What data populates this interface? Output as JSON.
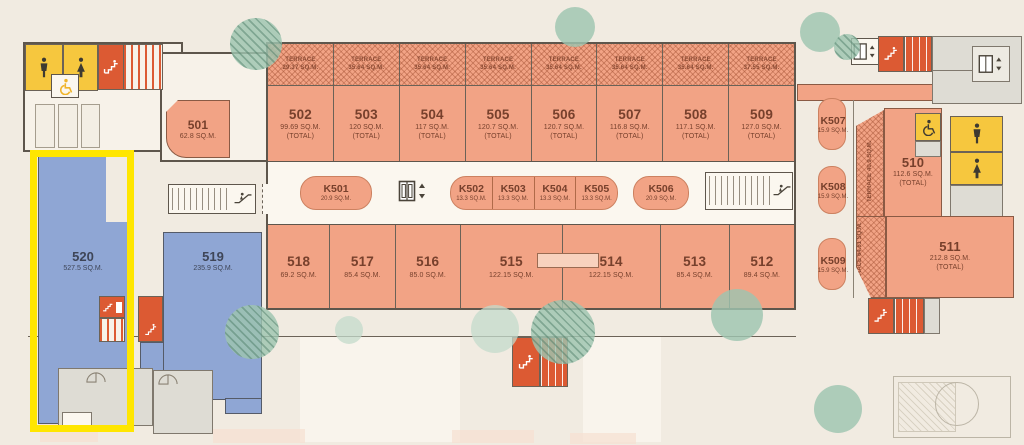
{
  "labels": {
    "terrace": "TERRACE",
    "total": "(TOTAL)"
  },
  "units": {
    "top": [
      {
        "id": "502",
        "area": "99.69 SQ.M.",
        "terrace_area": "29.37 SQ.M."
      },
      {
        "id": "503",
        "area": "120 SQ.M.",
        "terrace_area": "35.64 SQ.M."
      },
      {
        "id": "504",
        "area": "117 SQ.M.",
        "terrace_area": "35.64 SQ.M."
      },
      {
        "id": "505",
        "area": "120.7 SQ.M.",
        "terrace_area": "35.64 SQ.M."
      },
      {
        "id": "506",
        "area": "120.7 SQ.M.",
        "terrace_area": "35.64 SQ.M."
      },
      {
        "id": "507",
        "area": "116.8 SQ.M.",
        "terrace_area": "35.64 SQ.M."
      },
      {
        "id": "508",
        "area": "117.1 SQ.M.",
        "terrace_area": "35.64 SQ.M."
      },
      {
        "id": "509",
        "area": "127.0 SQ.M.",
        "terrace_area": "37.55 SQ.M."
      }
    ],
    "bottom": [
      {
        "id": "518",
        "area": "69.2 SQ.M."
      },
      {
        "id": "517",
        "area": "85.4 SQ.M."
      },
      {
        "id": "516",
        "area": "85.0 SQ.M."
      },
      {
        "id": "515",
        "area": "122.15 SQ.M."
      },
      {
        "id": "514",
        "area": "122.15 SQ.M."
      },
      {
        "id": "513",
        "area": "85.4 SQ.M."
      },
      {
        "id": "512",
        "area": "89.4 SQ.M."
      }
    ],
    "left": [
      {
        "id": "501",
        "area": "62.8 SQ.M."
      },
      {
        "id": "520",
        "area": "527.5 SQ.M.",
        "highlighted": true
      },
      {
        "id": "519",
        "area": "235.9 SQ.M."
      }
    ],
    "right": [
      {
        "id": "510",
        "area": "112.6 SQ.M.",
        "terrace_label": "TERRACE",
        "terrace_area": "40.9 SQ.M."
      },
      {
        "id": "511",
        "area": "212.8 SQ.M.",
        "terrace_label": "TERRACE",
        "terrace_area": "64.61 SQ.M."
      }
    ]
  },
  "kiosks": [
    {
      "id": "K501",
      "area": "20.9 SQ.M."
    },
    {
      "id": "K502",
      "area": "13.3 SQ.M."
    },
    {
      "id": "K503",
      "area": "13.3 SQ.M."
    },
    {
      "id": "K504",
      "area": "13.3 SQ.M."
    },
    {
      "id": "K505",
      "area": "13.3 SQ.M."
    },
    {
      "id": "K506",
      "area": "20.9 SQ.M."
    },
    {
      "id": "K507",
      "area": "15.9 SQ.M."
    },
    {
      "id": "K508",
      "area": "15.9 SQ.M."
    },
    {
      "id": "K509",
      "area": "15.9 SQ.M."
    }
  ],
  "colors": {
    "background": "#F1EBE1",
    "unit_fill": "#F2A385",
    "blue_fill": "#8FA6D4",
    "wc_yellow": "#F6C73E",
    "stair_red": "#DC5A33",
    "highlight_yellow": "#FFE600",
    "tree_green": "#9EC4B0",
    "unit_text": "#77402C",
    "blue_text": "#3E4557"
  },
  "icons": {
    "male": "male-restroom-icon",
    "female": "female-restroom-icon",
    "wheelchair": "wheelchair-icon",
    "stairs": "stairs-icon",
    "escalator": "escalator-icon",
    "elevator": "elevator-icon",
    "door": "door-swing-icon"
  }
}
